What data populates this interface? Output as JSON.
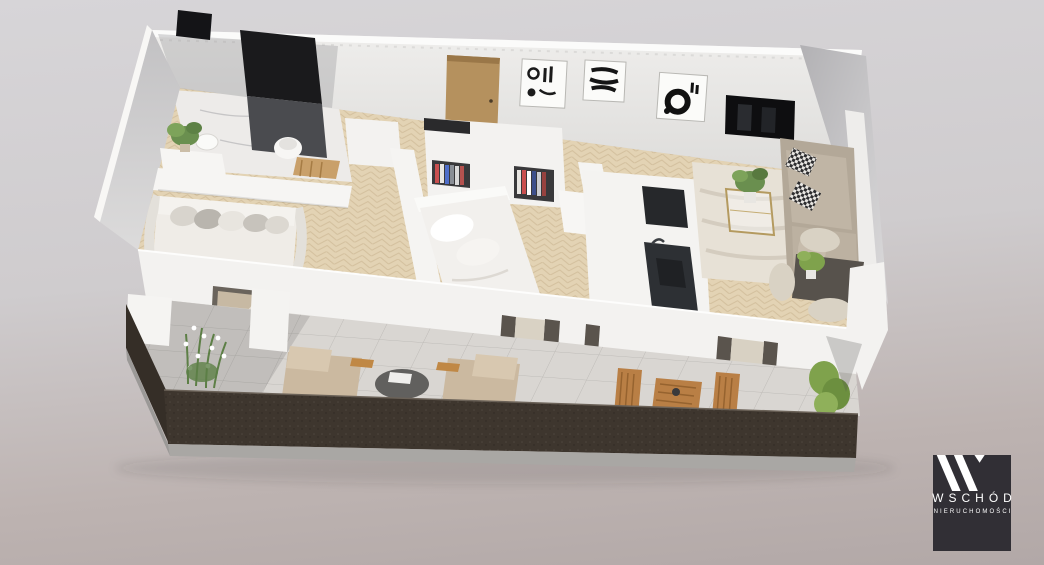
{
  "window": {
    "width": 1044,
    "height": 565,
    "description": "3D isometric rendering of an apartment floor plan with a long furnished balcony, shown on a soft gray gradient background with a developer logo watermark in the bottom-right corner"
  },
  "background": {
    "top": "#d7d5d8",
    "middle": "#cfccce",
    "bottom": "#b2a8a7"
  },
  "colors": {
    "wall_white": "#f3f2f0",
    "wall_inner_gray": "#c9c8ca",
    "floor_wood": "#e3d3b4",
    "bathroom_tile": "#edebe9",
    "shower_panel": "#1a1a1c",
    "shower_tile_gray": "#4a4b4f",
    "door_wood": "#b5915e",
    "tv_screen": "#0e0e10",
    "kitchen_dark": "#2d3034",
    "sofa_beige": "#b3a898",
    "bed_white": "#f2f0ed",
    "rug_cream": "#e7e1d6",
    "balcony_tile": "#d9d6d2",
    "railing_dark": "#3e362e",
    "concrete_edge": "#a9a7a4",
    "plant_green": "#7fa24c",
    "outdoor_wood": "#b97f45"
  },
  "logo": {
    "brand": "WSCHÓD",
    "tagline": "NIERUCHOMOŚCI",
    "background": "#312f35",
    "foreground": "#ffffff",
    "monogram": "double-slash-w-icon"
  },
  "scene": {
    "rooms": [
      {
        "name": "bathroom",
        "items": [
          "black-tiled-shower-wall",
          "toilet",
          "vanity-with-plant",
          "wall-mirror",
          "wooden-step-stool"
        ]
      },
      {
        "name": "hallway",
        "items": [
          "wooden-entry-door",
          "abstract-artwork-1",
          "abstract-artwork-2",
          "closet-with-hanging-clothes",
          "white-cabinets"
        ]
      },
      {
        "name": "bedroom-left",
        "items": [
          "daybed-sofa-with-pillows",
          "black-desk",
          "black-chair",
          "light-rug"
        ]
      },
      {
        "name": "bedroom-middle",
        "items": [
          "double-bed-white",
          "white-wardrobe",
          "drawer-unit",
          "open-closet-with-clothes"
        ]
      },
      {
        "name": "kitchen",
        "items": [
          "dark-counter-with-sink",
          "dark-tall-unit",
          "white-cabinet-block"
        ]
      },
      {
        "name": "living-room",
        "items": [
          "wall-mounted-tv",
          "circle-artwork",
          "beige-sofa-patterned-pillows",
          "gold-glass-coffee-table",
          "potted-plant",
          "cream-rug",
          "dark-dining-table",
          "cream-dining-chairs"
        ]
      },
      {
        "name": "balcony",
        "items": [
          "lounge-chair-left",
          "lounge-chair-right",
          "round-coffee-table",
          "wooden-dining-set",
          "white-flower-planter",
          "green-shrub",
          "dark-brown-parapet",
          "tiled-floor"
        ]
      }
    ]
  }
}
